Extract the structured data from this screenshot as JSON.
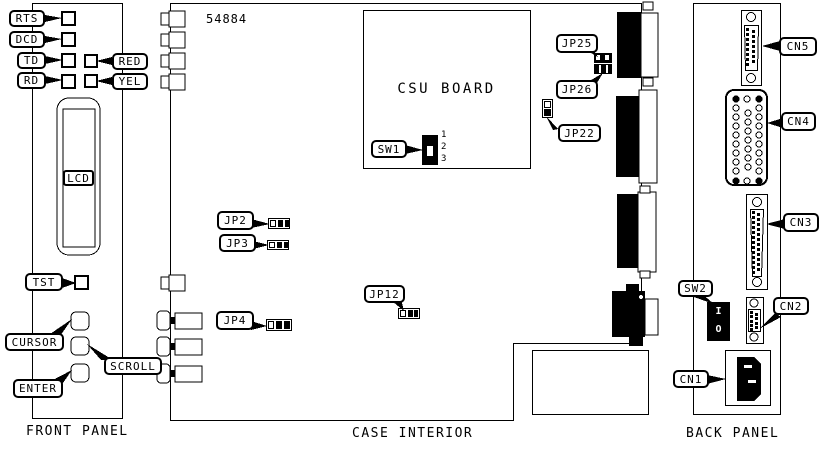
{
  "part_number": "54884",
  "sections": {
    "front_panel_caption": "FRONT PANEL",
    "case_interior_caption": "CASE INTERIOR",
    "back_panel_caption": "BACK PANEL"
  },
  "front_panel": {
    "rts": "RTS",
    "dcd": "DCD",
    "td": "TD",
    "rd": "RD",
    "red": "RED",
    "yel": "YEL",
    "lcd": "LCD",
    "tst": "TST",
    "cursor": "CURSOR",
    "scroll": "SCROLL",
    "enter": "ENTER"
  },
  "case_interior": {
    "board_name": "CSU BOARD",
    "sw1": "SW1",
    "sw1_positions": [
      "1",
      "2",
      "3"
    ],
    "jp25": "JP25",
    "jp26": "JP26",
    "jp22": "JP22",
    "jp2": "JP2",
    "jp3": "JP3",
    "jp12": "JP12",
    "jp4": "JP4"
  },
  "back_panel": {
    "cn5": "CN5",
    "cn4": "CN4",
    "cn3": "CN3",
    "cn2": "CN2",
    "cn1": "CN1",
    "sw2": "SW2",
    "sw2_on": "I",
    "sw2_off": "O"
  }
}
